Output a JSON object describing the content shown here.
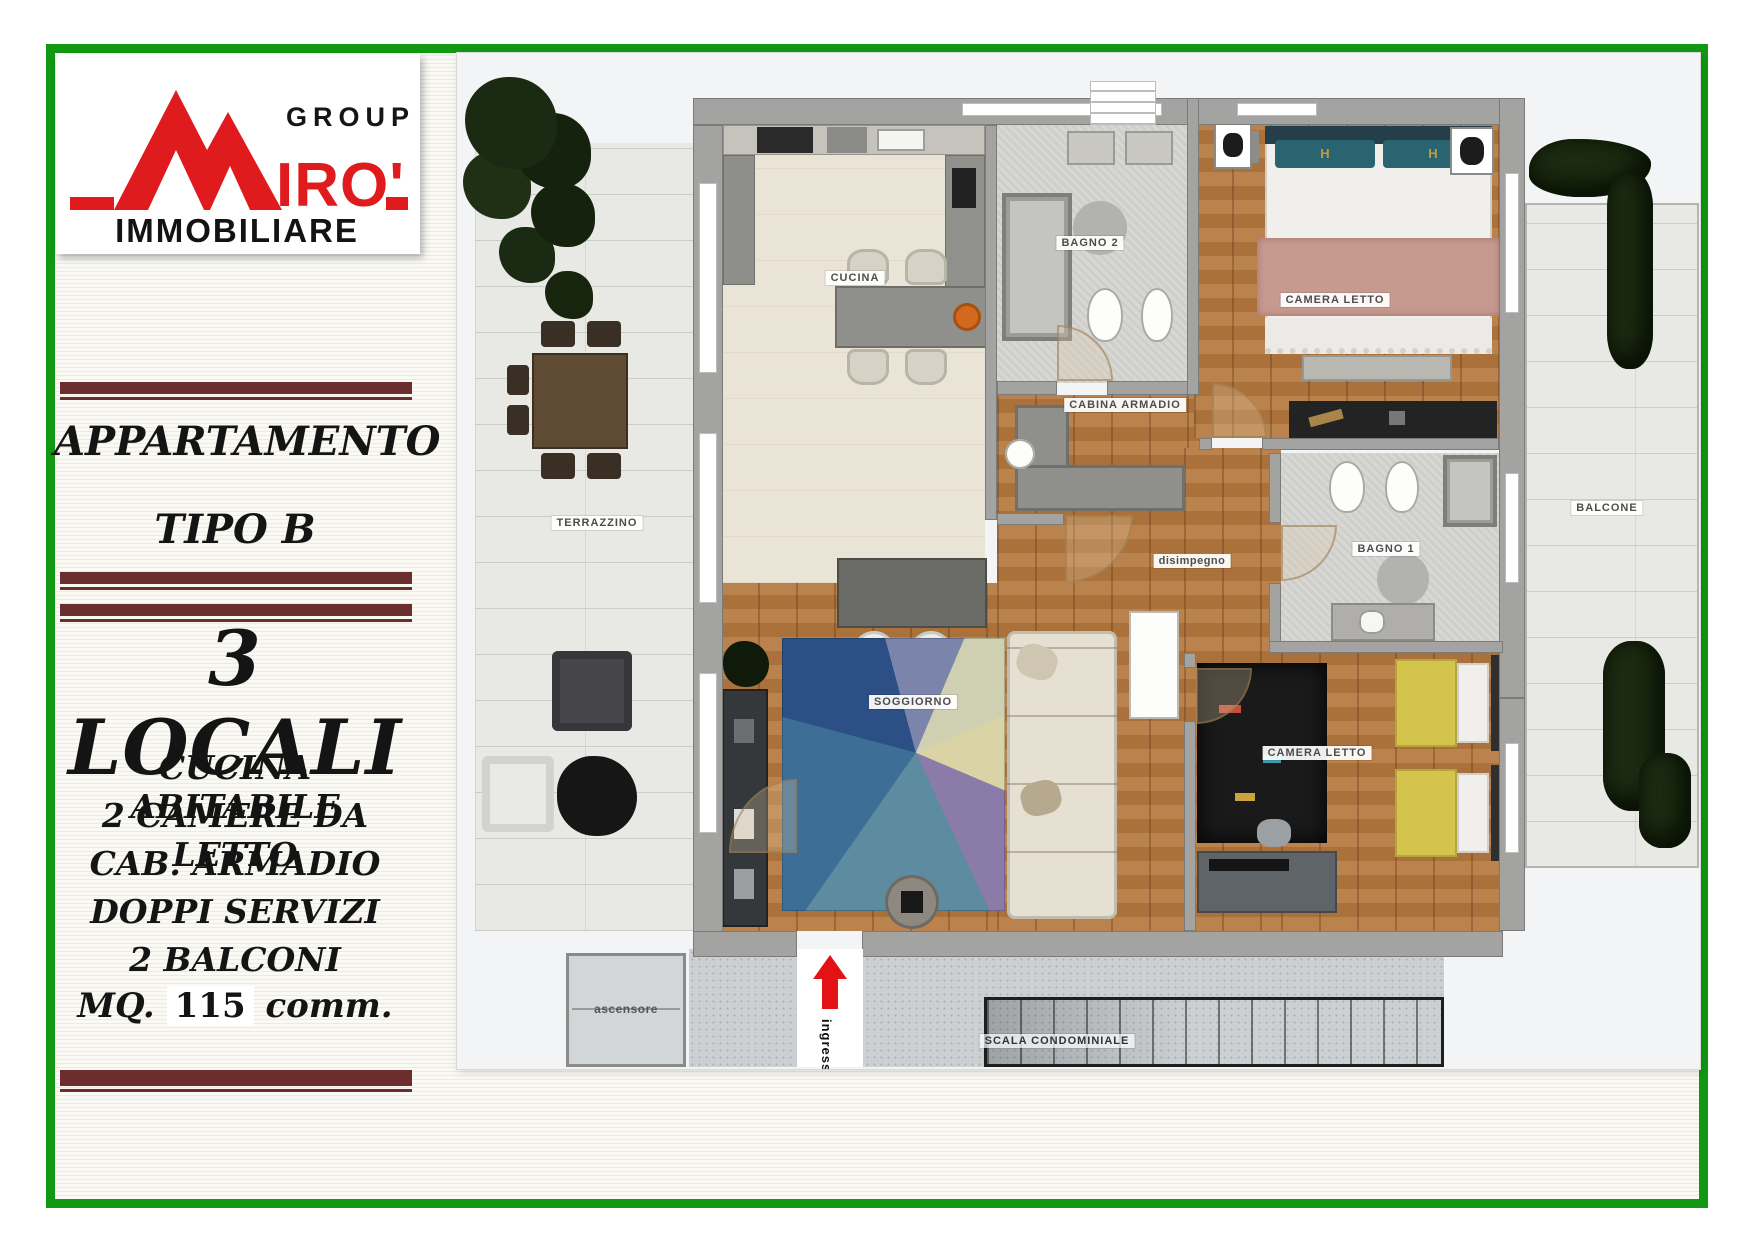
{
  "frame": {
    "border_color": "#129812"
  },
  "brand": {
    "group": "GROUP",
    "name": "MIRO'",
    "name_display": "IRO'",
    "sub": "IMMOBILIARE",
    "red": "#e01b1e"
  },
  "sidebar": {
    "title_line1": "APPARTAMENTO",
    "title_line2": "TIPO B",
    "headline": "3 LOCALI",
    "features": [
      "CUCINA ABITABILE",
      "2 CAMERE DA LETTO",
      "CAB. ARMADIO",
      "DOPPI SERVIZI",
      "2 BALCONI"
    ],
    "area_prefix": "MQ.",
    "area_value": "115",
    "area_suffix": "comm.",
    "accent_color": "#6b2d2d"
  },
  "floorplan": {
    "labels": {
      "cucina": "CUCINA",
      "bagno2": "BAGNO 2",
      "camera_letto_1": "CAMERA LETTO",
      "cabina_armadio": "CABINA ARMADIO",
      "terrazzino": "TERRAZZINO",
      "disimpegno": "disimpegno",
      "bagno1": "BAGNO 1",
      "balcone": "BALCONE",
      "soggiorno": "SOGGIORNO",
      "camera_letto_2": "CAMERA LETTO",
      "ascensore": "ascensore",
      "scala": "SCALA CONDOMINIALE",
      "ingresso": "ingresso"
    },
    "pillow_monogram": "H",
    "entry_arrow_color": "#e41313"
  }
}
